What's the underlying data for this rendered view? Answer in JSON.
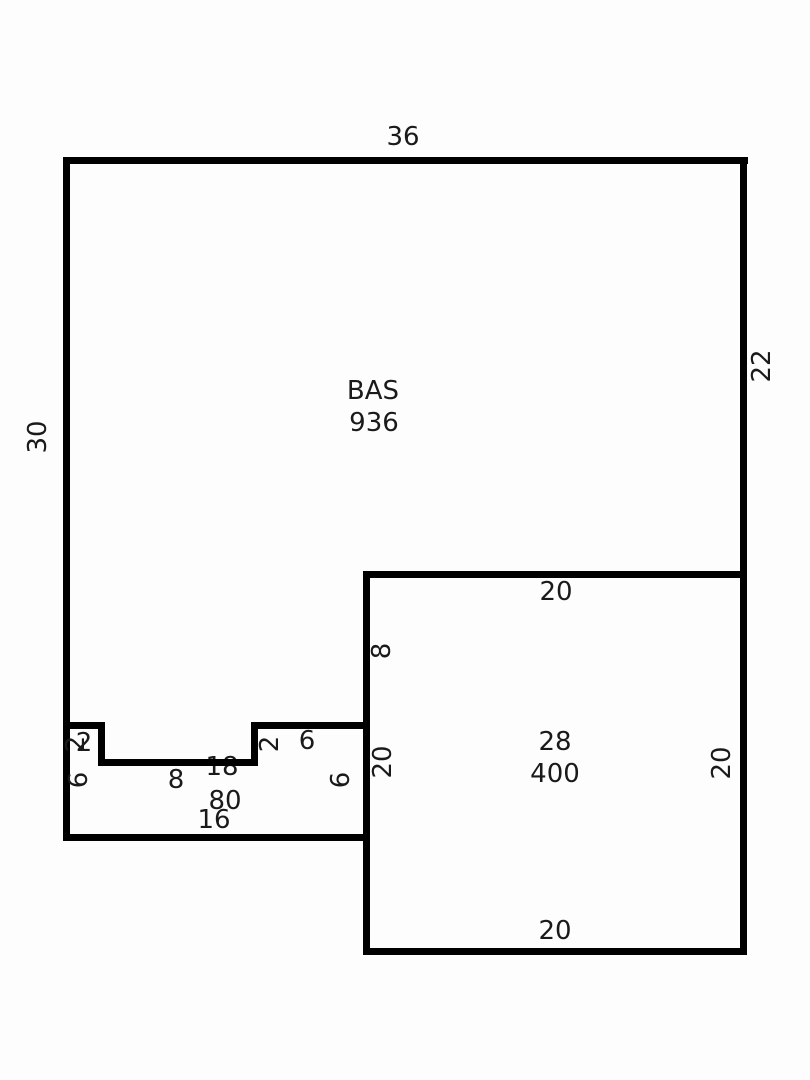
{
  "canvas": {
    "width": 810,
    "height": 1080,
    "background": "#fdfdfd",
    "wall_color": "#000000",
    "text_color": "#1a1a1a"
  },
  "diagram": {
    "type": "floorplan-sketch",
    "areas": [
      {
        "name": "BAS",
        "area_value": "936"
      },
      {
        "name": "28",
        "area_value": "400"
      },
      {
        "name": "18",
        "area_value": "80"
      }
    ],
    "walls": [
      {
        "name": "wall-outer-top",
        "x": 63,
        "y": 157,
        "w": 685,
        "h": 7
      },
      {
        "name": "wall-outer-left",
        "x": 63,
        "y": 157,
        "w": 7,
        "h": 684
      },
      {
        "name": "wall-outer-right",
        "x": 740,
        "y": 157,
        "w": 7,
        "h": 798
      },
      {
        "name": "wall-square-top",
        "x": 363,
        "y": 571,
        "w": 384,
        "h": 7
      },
      {
        "name": "wall-square-left",
        "x": 363,
        "y": 571,
        "w": 7,
        "h": 384
      },
      {
        "name": "wall-square-bottom",
        "x": 363,
        "y": 948,
        "w": 384,
        "h": 7
      },
      {
        "name": "wall-strip-bottom",
        "x": 63,
        "y": 834,
        "w": 307,
        "h": 7
      },
      {
        "name": "wall-notch-left-top",
        "x": 63,
        "y": 722,
        "w": 42,
        "h": 7
      },
      {
        "name": "wall-notch-left-vert",
        "x": 98,
        "y": 722,
        "w": 7,
        "h": 44
      },
      {
        "name": "wall-notch-bottom",
        "x": 98,
        "y": 759,
        "w": 160,
        "h": 7
      },
      {
        "name": "wall-notch-right-vert",
        "x": 251,
        "y": 722,
        "w": 7,
        "h": 44
      },
      {
        "name": "wall-notch-right-top",
        "x": 251,
        "y": 722,
        "w": 119,
        "h": 7
      }
    ],
    "labels": [
      {
        "name": "dim-outer-top-36",
        "text": "36",
        "cx": 403,
        "cy": 137,
        "rot": false
      },
      {
        "name": "dim-outer-left-30",
        "text": "30",
        "cx": 38,
        "cy": 437,
        "rot": true
      },
      {
        "name": "dim-outer-right-22",
        "text": "22",
        "cx": 762,
        "cy": 366,
        "rot": true
      },
      {
        "name": "area-bas-name",
        "text": "BAS",
        "cx": 373,
        "cy": 391,
        "rot": false
      },
      {
        "name": "area-bas-value-936",
        "text": "936",
        "cx": 374,
        "cy": 423,
        "rot": false
      },
      {
        "name": "dim-square-top-20",
        "text": "20",
        "cx": 556,
        "cy": 592,
        "rot": false
      },
      {
        "name": "dim-square-left-8",
        "text": "8",
        "cx": 382,
        "cy": 651,
        "rot": true
      },
      {
        "name": "dim-square-left-20",
        "text": "20",
        "cx": 383,
        "cy": 762,
        "rot": true
      },
      {
        "name": "area-square-name-28",
        "text": "28",
        "cx": 555,
        "cy": 742,
        "rot": false
      },
      {
        "name": "area-square-value-400",
        "text": "400",
        "cx": 555,
        "cy": 774,
        "rot": false
      },
      {
        "name": "dim-square-right-20",
        "text": "20",
        "cx": 722,
        "cy": 763,
        "rot": true
      },
      {
        "name": "dim-square-bottom-20",
        "text": "20",
        "cx": 555,
        "cy": 931,
        "rot": false
      },
      {
        "name": "dim-notch-left-top-2",
        "text": "2",
        "cx": 84,
        "cy": 743,
        "rot": false
      },
      {
        "name": "dim-notch-left-vert-2",
        "text": "2",
        "cx": 76,
        "cy": 744,
        "rot": true
      },
      {
        "name": "dim-strip-left-6",
        "text": "6",
        "cx": 79,
        "cy": 780,
        "rot": true
      },
      {
        "name": "dim-notch-bottom-8",
        "text": "8",
        "cx": 176,
        "cy": 780,
        "rot": false
      },
      {
        "name": "label-strip-18",
        "text": "18",
        "cx": 222,
        "cy": 767,
        "rot": false,
        "behind": true
      },
      {
        "name": "dim-notch-right-vert-2",
        "text": "2",
        "cx": 270,
        "cy": 744,
        "rot": true
      },
      {
        "name": "dim-notch-right-top-6",
        "text": "6",
        "cx": 307,
        "cy": 741,
        "rot": false
      },
      {
        "name": "dim-strip-right-6",
        "text": "6",
        "cx": 341,
        "cy": 780,
        "rot": true
      },
      {
        "name": "area-strip-value-80",
        "text": "80",
        "cx": 225,
        "cy": 801,
        "rot": false
      },
      {
        "name": "dim-strip-bottom-16",
        "text": "16",
        "cx": 214,
        "cy": 820,
        "rot": false
      }
    ]
  }
}
